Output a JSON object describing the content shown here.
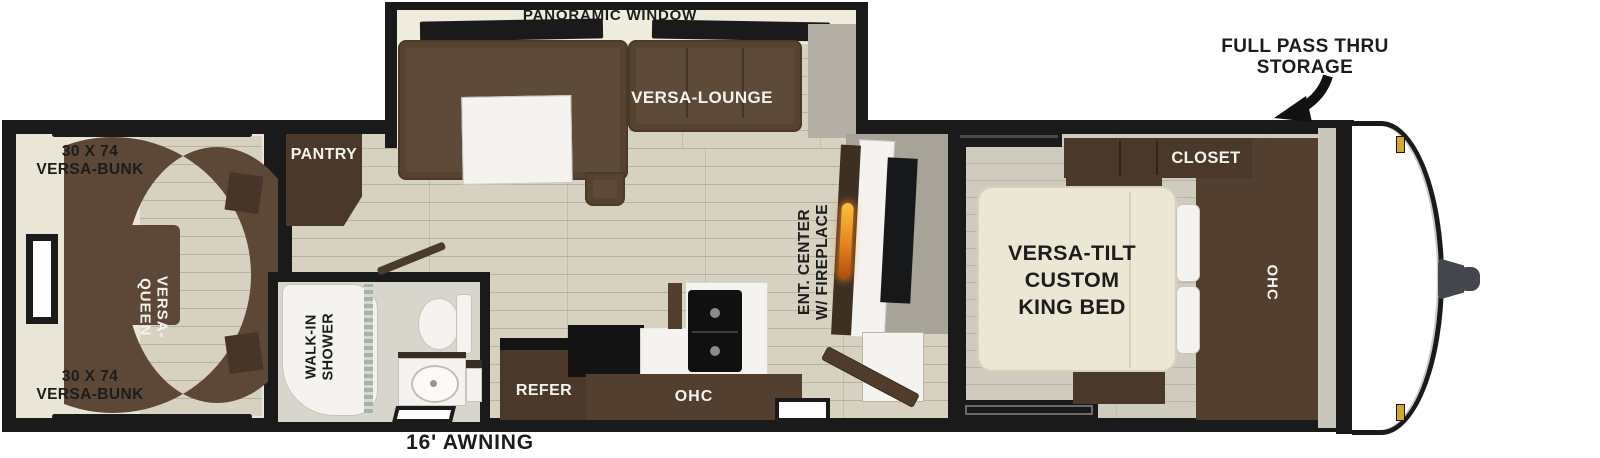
{
  "plan": {
    "rear_room": {
      "bunk_top_l1": "30 X 74",
      "bunk_top_l2": "VERSA-BUNK",
      "bunk_bottom_l1": "30 X 74",
      "bunk_bottom_l2": "VERSA-BUNK",
      "queen": "VERSA-QUEEN"
    },
    "slideout": {
      "panoramic": "PANORAMIC WINDOW",
      "lounge": "VERSA-LOUNGE"
    },
    "kitchen": {
      "pantry": "PANTRY",
      "refer": "REFER",
      "ohc": "OHC"
    },
    "bath": {
      "shower_l1": "WALK-IN",
      "shower_l2": "SHOWER"
    },
    "living": {
      "ent_l1": "ENT. CENTER",
      "ent_l2": "W/ FIREPLACE"
    },
    "bedroom": {
      "closet": "CLOSET",
      "ohc": "OHC",
      "bed_l1": "VERSA-TILT",
      "bed_l2": "CUSTOM",
      "bed_l3": "KING BED"
    },
    "front": {
      "storage_l1": "FULL PASS THRU",
      "storage_l2": "STORAGE"
    },
    "awning": "16' AWNING",
    "colors": {
      "wall": "#1a1a1a",
      "interior_wall": "#e9e5d7",
      "floor": "#d6d1c1",
      "bedroom_floor": "#cfcbbe",
      "sofa_brown": "#5e4a39",
      "cabinet_brown": "#4a392b",
      "bed_cream": "#ece7d5",
      "accent_gray": "#a7a399",
      "fireplace_flame": "#e8821e",
      "clearance_light_gold": "#d4a92a"
    }
  }
}
